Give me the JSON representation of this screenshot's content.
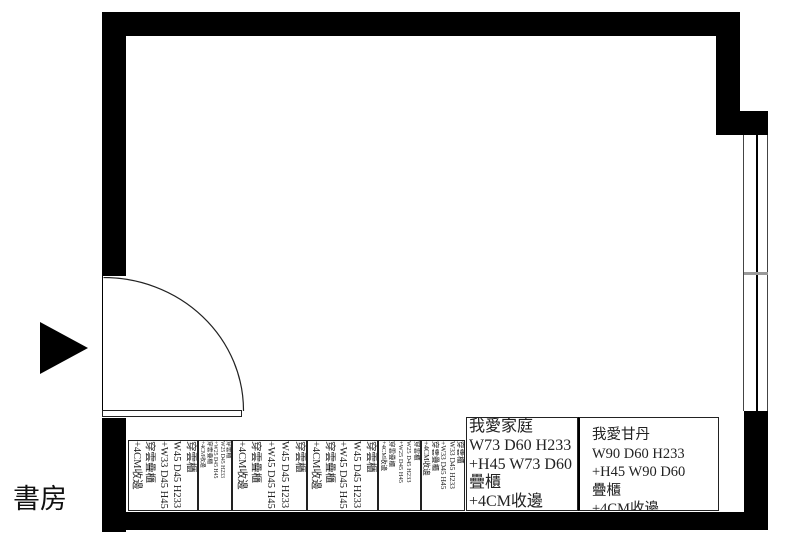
{
  "room": {
    "label": "書房"
  },
  "colors": {
    "wall": "#000000",
    "window_line": "#444444",
    "sill_gray": "#999999"
  },
  "cabinets": {
    "vertical": [
      {
        "lines": [
          "穿雲櫃",
          "W45 D45 H233",
          "+W33 D45 H45",
          "穿雲疊櫃",
          "+4CM收邊"
        ]
      },
      {
        "lines": [
          "穿雲櫃",
          "W25 D45 H233",
          "+W25 D45 H45",
          "穿雲疊櫃",
          "+4CM收邊"
        ]
      },
      {
        "lines": [
          "穿雲櫃",
          "W45 D45 H233",
          "+W45 D45 H45",
          "穿雲疊櫃",
          "+4CM收邊"
        ]
      },
      {
        "lines": [
          "穿雲櫃",
          "W45 D45 H233",
          "+W45 D45 H45",
          "穿雲疊櫃",
          "+4CM收邊"
        ]
      },
      {
        "lines": [
          "穿雲櫃",
          "W25 D45 H233",
          "+W25 D45 H45",
          "穿雲疊櫃",
          "+4CM收邊"
        ]
      },
      {
        "lines": [
          "穿雲櫃",
          "W33 D45 H233",
          "+W33 D45 H45",
          "穿雲疊櫃",
          "+4CM收邊"
        ]
      }
    ],
    "horizontal": [
      {
        "lines": [
          "我愛家庭",
          "W73 D60 H233",
          "+H45 W73 D60",
          "疊櫃",
          "+4CM收邊"
        ]
      },
      {
        "lines": [
          "我愛甘丹",
          "W90 D60 H233",
          "+H45 W90 D60",
          "疊櫃",
          "+4CM收邊"
        ]
      }
    ]
  }
}
